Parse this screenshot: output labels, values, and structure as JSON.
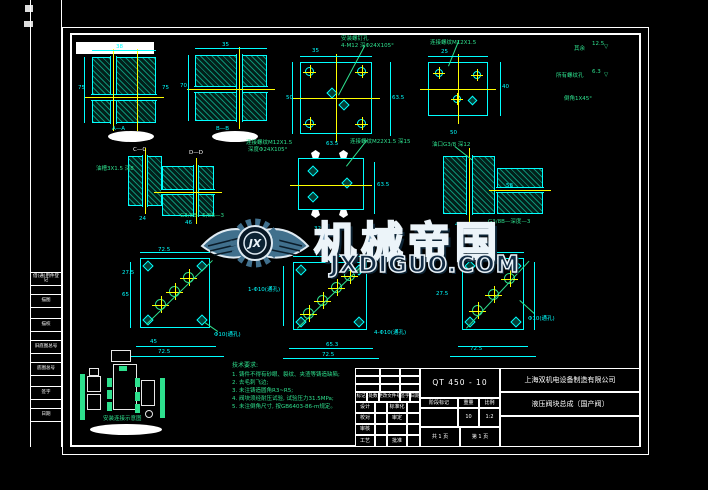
{
  "colors": {
    "line": "#00ffff",
    "centerline": "#ffff00",
    "annotation": "#2ee08e",
    "frame": "#ffffff",
    "watermark_fill": "#7fa3bd",
    "watermark_url_fill": "#132c44"
  },
  "watermark": {
    "brand": "机械帝国",
    "url": "JXDIGUO.COM",
    "logo_initials": "JX"
  },
  "binding_column": {
    "items": [
      "借(通)用件登记",
      "描图",
      "描校",
      "旧底图总号",
      "底图总号",
      "签字",
      "日期"
    ]
  },
  "notes": {
    "title": "技术要求:",
    "lines": [
      "1. 铸件不得有砂眼、裂纹、夹渣等铸造缺陷;",
      "2. 去毛刺飞边;",
      "3. 未注铸造圆角R3~R5;",
      "4. 阀块须经耐压试验, 试验压力31.5MPa;",
      "5. 未注倒角尺寸, 按GB6403-86-m规定。"
    ]
  },
  "schematic": {
    "caption": "安装连接示意图"
  },
  "title_block": {
    "company": "上海双机电设备制造有限公司",
    "part_name": "液压阀块总成〔国产阀〕",
    "material": "QT 450 - 10",
    "revision_header": [
      "标记",
      "处数",
      "更改文件号",
      "签字",
      "日期"
    ],
    "sign_col1": [
      "设计",
      "校对",
      "审核",
      "工艺"
    ],
    "sign_col2": [
      "标准化",
      "审定",
      "",
      "批准"
    ],
    "stage_labels": [
      "阶段标记",
      "重量",
      "比例"
    ],
    "stage_values": [
      "",
      "10",
      "1:2"
    ],
    "sheet_total": "共 1 页",
    "sheet_no": "第 1 页"
  },
  "floating_labels": [
    {
      "x": 116,
      "y": 44,
      "t": "38",
      "c": "cy"
    },
    {
      "x": 78,
      "y": 85,
      "t": "75",
      "c": "cy"
    },
    {
      "x": 162,
      "y": 85,
      "t": "75",
      "c": "cy"
    },
    {
      "x": 112,
      "y": 126,
      "t": "A—A",
      "c": "cy"
    },
    {
      "x": 222,
      "y": 42,
      "t": "35",
      "c": "cy"
    },
    {
      "x": 180,
      "y": 83,
      "t": "70",
      "c": "cy"
    },
    {
      "x": 216,
      "y": 126,
      "t": "B—B",
      "c": "cy"
    },
    {
      "x": 312,
      "y": 48,
      "t": "35",
      "c": "cy"
    },
    {
      "x": 286,
      "y": 95,
      "t": "50",
      "c": "cy"
    },
    {
      "x": 392,
      "y": 95,
      "t": "63.5",
      "c": "cy"
    },
    {
      "x": 341,
      "y": 36,
      "t": "安装螺钉孔",
      "c": "gr"
    },
    {
      "x": 341,
      "y": 43,
      "t": "4-M12 深Φ24X105°",
      "c": "gr"
    },
    {
      "x": 326,
      "y": 141,
      "t": "63.5",
      "c": "cy"
    },
    {
      "x": 441,
      "y": 49,
      "t": "25",
      "c": "cy"
    },
    {
      "x": 502,
      "y": 84,
      "t": "40",
      "c": "cy"
    },
    {
      "x": 430,
      "y": 40,
      "t": "连接螺纹M12X1.5",
      "c": "gr"
    },
    {
      "x": 450,
      "y": 130,
      "t": "50",
      "c": "cy"
    },
    {
      "x": 574,
      "y": 46,
      "t": "其余",
      "c": "gr"
    },
    {
      "x": 592,
      "y": 41,
      "t": "12.5",
      "c": "gr"
    },
    {
      "x": 604,
      "y": 44,
      "t": "▽",
      "c": "gr"
    },
    {
      "x": 556,
      "y": 73,
      "t": "所有螺纹孔",
      "c": "gr"
    },
    {
      "x": 592,
      "y": 69,
      "t": "6.3",
      "c": "gr"
    },
    {
      "x": 604,
      "y": 72,
      "t": "▽",
      "c": "gr"
    },
    {
      "x": 564,
      "y": 96,
      "t": "倒角1X45°",
      "c": "gr"
    },
    {
      "x": 133,
      "y": 147,
      "t": "C—C",
      "c": "wh"
    },
    {
      "x": 189,
      "y": 150,
      "t": "D—D",
      "c": "wh"
    },
    {
      "x": 96,
      "y": 166,
      "t": "油槽3X1.5 深8",
      "c": "gr"
    },
    {
      "x": 139,
      "y": 216,
      "t": "24",
      "c": "cy"
    },
    {
      "x": 185,
      "y": 220,
      "t": "46",
      "c": "cy"
    },
    {
      "x": 246,
      "y": 140,
      "t": "连接螺纹M12X1.5",
      "c": "gr"
    },
    {
      "x": 248,
      "y": 147,
      "t": "深度Φ24X105°",
      "c": "gr"
    },
    {
      "x": 350,
      "y": 139,
      "t": "连接螺纹M22X1.5 深15",
      "c": "gr"
    },
    {
      "x": 377,
      "y": 182,
      "t": "63.5",
      "c": "cy"
    },
    {
      "x": 314,
      "y": 226,
      "t": "32",
      "c": "cy"
    },
    {
      "x": 432,
      "y": 142,
      "t": "油口G3/8 深12",
      "c": "gr"
    },
    {
      "x": 455,
      "y": 222,
      "t": "45",
      "c": "cy"
    },
    {
      "x": 506,
      "y": 183,
      "t": "58",
      "c": "cy"
    },
    {
      "x": 180,
      "y": 213,
      "t": "G3/8B—5/8B—3",
      "c": "gr"
    },
    {
      "x": 488,
      "y": 219,
      "t": "G3/8B—深度—3",
      "c": "gr"
    },
    {
      "x": 158,
      "y": 247,
      "t": "72.5",
      "c": "cy"
    },
    {
      "x": 122,
      "y": 270,
      "t": "27.5",
      "c": "cy"
    },
    {
      "x": 122,
      "y": 292,
      "t": "65",
      "c": "cy"
    },
    {
      "x": 150,
      "y": 339,
      "t": "45",
      "c": "cy"
    },
    {
      "x": 158,
      "y": 349,
      "t": "72.5",
      "c": "cy"
    },
    {
      "x": 214,
      "y": 332,
      "t": "Φ10(通孔)",
      "c": "cy"
    },
    {
      "x": 314,
      "y": 249,
      "t": "27.5",
      "c": "cy"
    },
    {
      "x": 248,
      "y": 287,
      "t": "1-Φ10(通孔)",
      "c": "cy"
    },
    {
      "x": 326,
      "y": 342,
      "t": "65.3",
      "c": "cy"
    },
    {
      "x": 322,
      "y": 352,
      "t": "72.5",
      "c": "cy"
    },
    {
      "x": 374,
      "y": 330,
      "t": "4-Φ10(通孔)",
      "c": "cy"
    },
    {
      "x": 476,
      "y": 247,
      "t": "72.5",
      "c": "cy"
    },
    {
      "x": 436,
      "y": 291,
      "t": "27.5",
      "c": "cy"
    },
    {
      "x": 528,
      "y": 316,
      "t": "Φ10(通孔)",
      "c": "cy"
    },
    {
      "x": 470,
      "y": 346,
      "t": "72.5",
      "c": "cy"
    },
    {
      "x": 103,
      "y": 416,
      "t": "安装连接示意图",
      "c": "gr"
    }
  ]
}
